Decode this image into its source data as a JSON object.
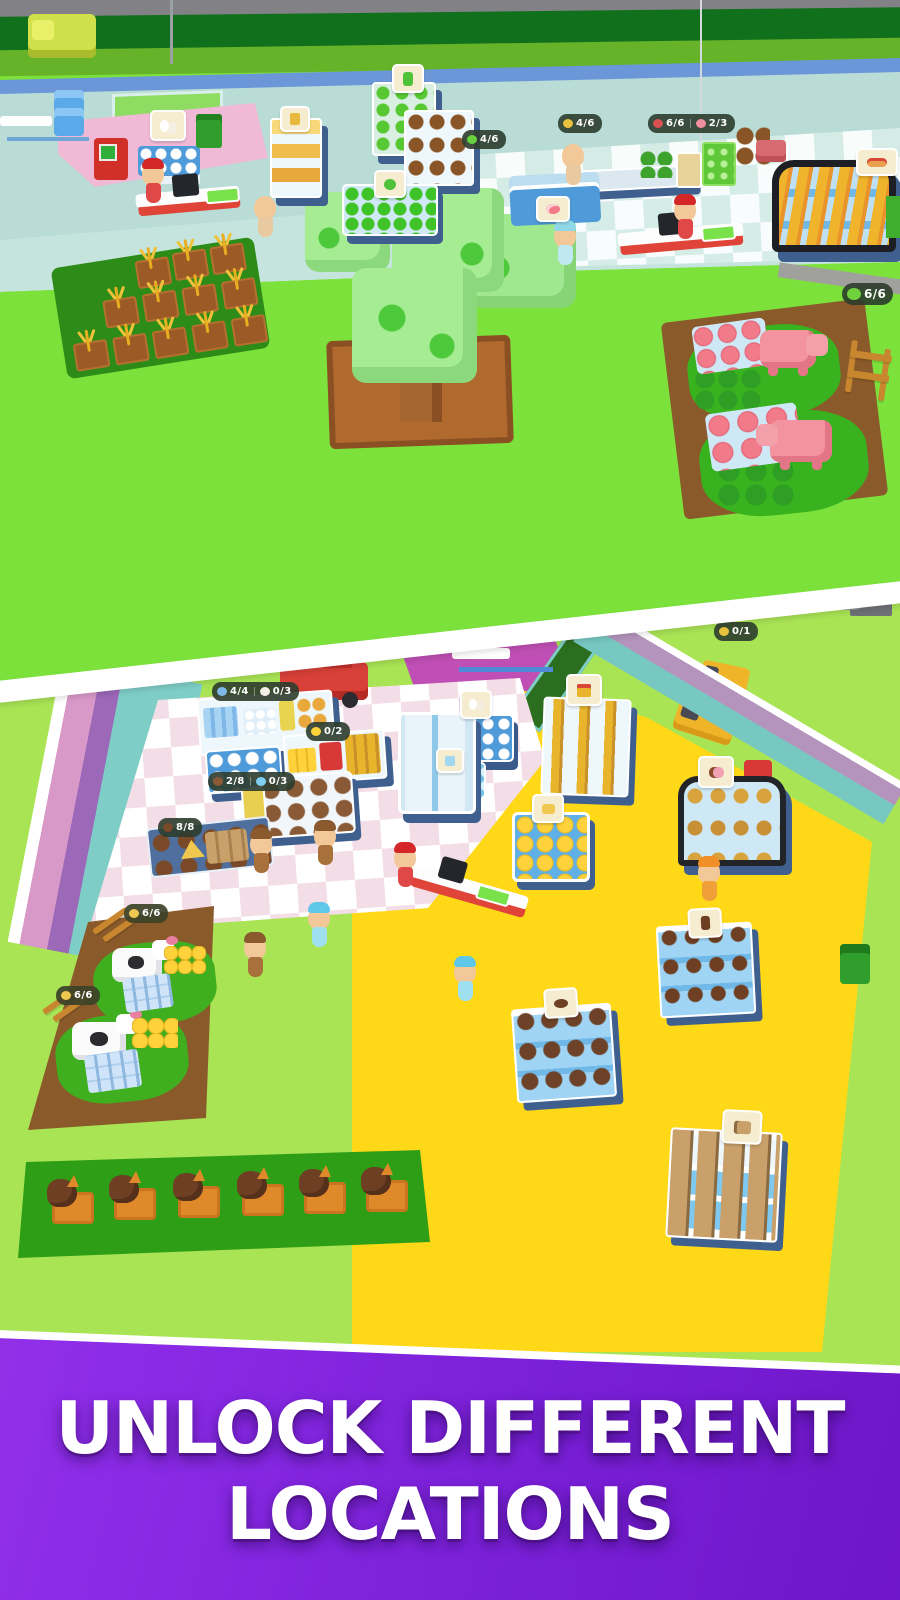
{
  "banner": {
    "line1": "UNLOCK DIFFERENT",
    "line2": "LOCATIONS"
  },
  "scene1": {
    "name": "farm supermarket with orchard, wheat field and pig pen",
    "badges": {
      "apples": {
        "icon": "green-apple",
        "text": "6/6"
      },
      "produce": {
        "icon": "green-crate",
        "text": "4/6"
      },
      "dairy": {
        "icon": "gold-item",
        "text": "4/6"
      },
      "deli_stock": {
        "icon": "red-item",
        "text": "6/6"
      },
      "deli_meat": {
        "icon": "meat",
        "text": "2/3"
      }
    }
  },
  "scene2": {
    "name": "bakery market with cow pens, cocoa planters and delivery trucks",
    "badges": {
      "pen_top": {
        "icon": "butter",
        "text": "6/6"
      },
      "pen_bottom": {
        "icon": "butter",
        "text": "6/6"
      },
      "dairy_stock": {
        "icon": "milk",
        "text": "4/4"
      },
      "dairy_extra": {
        "icon": "egg",
        "text": "0/3"
      },
      "cheese": {
        "icon": "cheese",
        "text": "0/2"
      },
      "icecream_stock": {
        "icon": "cocoa",
        "text": "2/8"
      },
      "icecream_extra": {
        "icon": "ice",
        "text": "0/3"
      },
      "meat": {
        "icon": "roast",
        "text": "8/8"
      },
      "delivery": {
        "icon": "coin",
        "text": "0/1"
      }
    }
  },
  "colors": {
    "banner_purple_top": "#9a34ec",
    "banner_purple_bottom": "#6f16c8",
    "grass_scene1": "#7ce23b",
    "grass_scene2": "#a9e455",
    "yellow_floor": "#ffd818",
    "magenta_room": "#bf4fb4",
    "teal_wall": "#b9dcd6",
    "badge_bg": "#2c3c2e"
  }
}
